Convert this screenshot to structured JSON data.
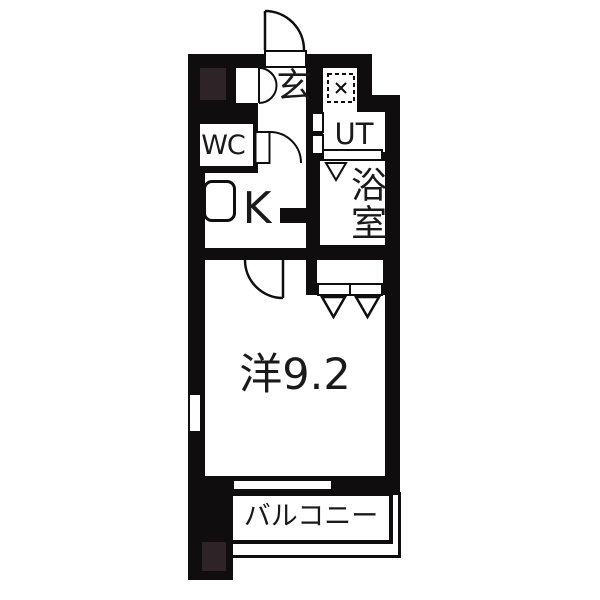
{
  "floorplan": {
    "labels": {
      "entrance": "玄",
      "toilet": "WC",
      "utility": "UT",
      "bathroom": "浴室",
      "kitchen": "K",
      "main_room": "洋9.2",
      "balcony": "バルコニー"
    },
    "colors": {
      "wall": "#0f0d0e",
      "pillar": "#2e2427",
      "floor": "#ffffff",
      "text": "#1a1a1a"
    }
  }
}
